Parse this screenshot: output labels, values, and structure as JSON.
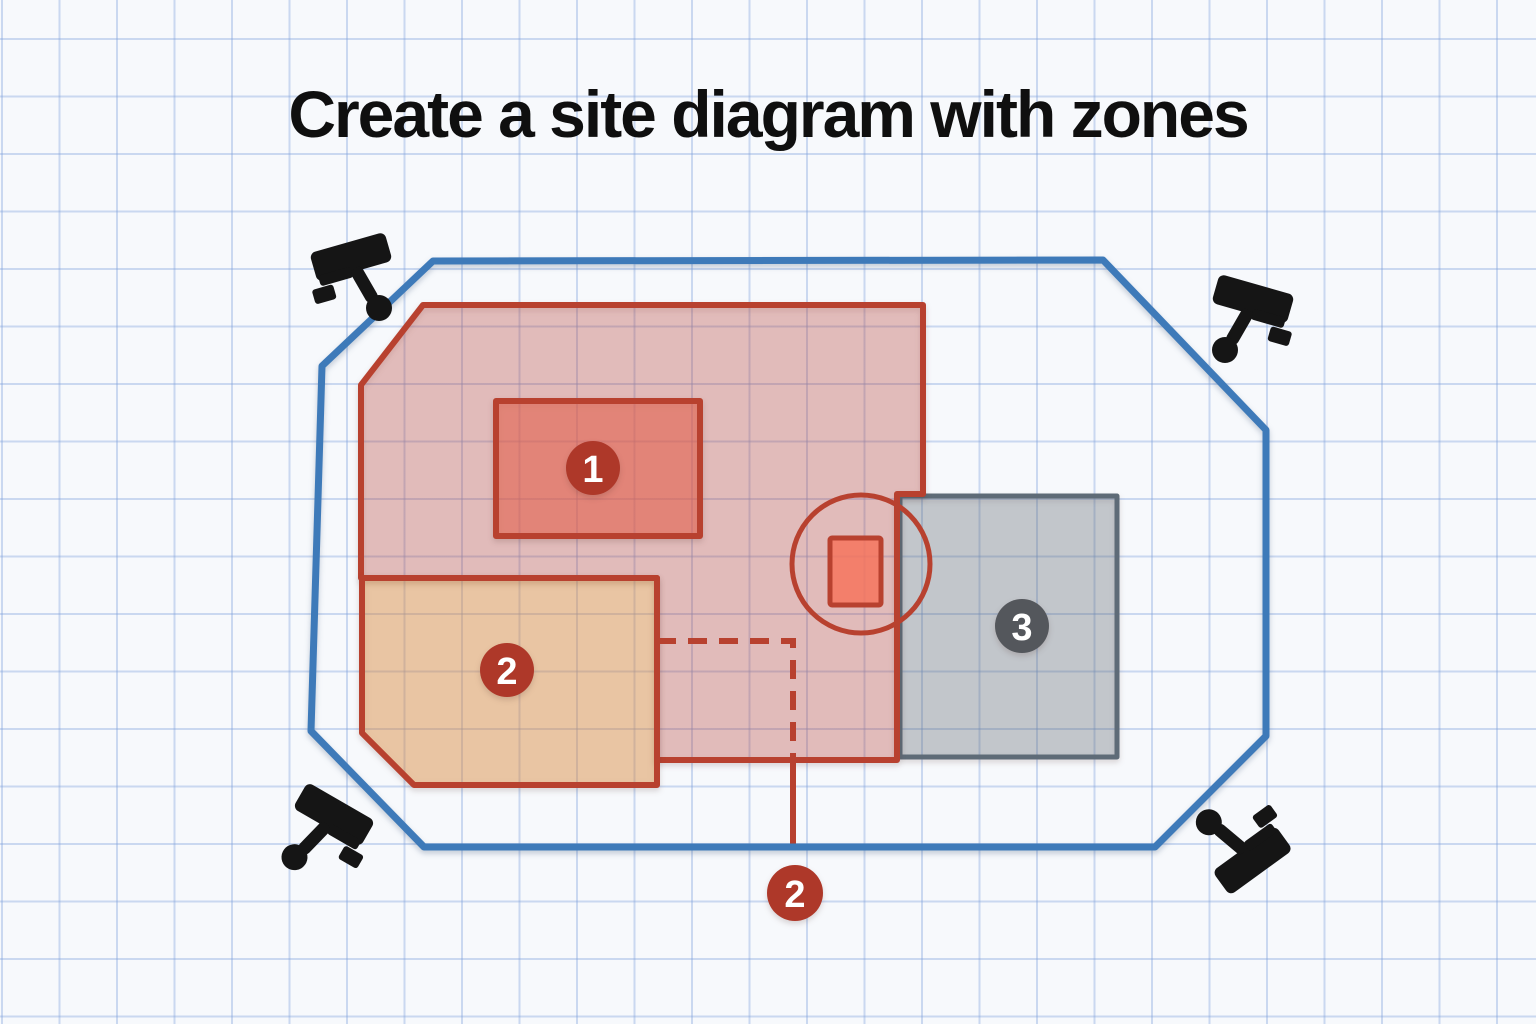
{
  "title": "Create a site diagram with zones",
  "colors": {
    "paper": "#f7f9fc",
    "grid_line": "#cdd9ef",
    "perimeter_blue": "#3e7ab9",
    "zone_red_stroke": "#b8412f",
    "zone_red_fill": "rgba(197,70,58,0.30)",
    "building_fill": "rgba(240,96,72,0.52)",
    "zone_orange_fill": "rgba(231,140,52,0.40)",
    "zone_gray_stroke": "#5e6b77",
    "zone_gray_fill": "rgba(93,105,117,0.30)",
    "equipment_rect_fill": "rgba(247,112,88,0.80)",
    "marker_red": "#ae3829",
    "marker_gray": "#54575c",
    "marker_text": "#ffffff",
    "camera_black": "#151515",
    "title_color": "#0f0f0f"
  },
  "diagram": {
    "perimeter": {
      "name": "site-perimeter-boundary",
      "points": "433,261 1103,260 1266,430 1266,736 1155,847 424,847 311,731 322,366",
      "stroke_key": "perimeter_blue",
      "stroke_width": 7
    },
    "zones": [
      {
        "name": "zone-3-area",
        "shape": "rect",
        "x": 900,
        "y": 496,
        "w": 217,
        "h": 261,
        "fill_key": "zone_gray_fill",
        "stroke_key": "zone_gray_stroke",
        "stroke_width": 5
      },
      {
        "name": "zone-1-area",
        "shape": "polygon",
        "points": "423,305 923,305 923,494 897,494 897,760 657,760 657,578 361,578 361,385",
        "fill_key": "zone_red_fill",
        "stroke_key": "zone_red_stroke",
        "stroke_width": 6
      },
      {
        "name": "zone-2-area",
        "shape": "polygon",
        "points": "362,578 657,578 657,785 414,785 362,733",
        "fill_key": "zone_orange_fill",
        "stroke_key": "zone_red_stroke",
        "stroke_width": 6
      },
      {
        "name": "building-1-rect",
        "shape": "rect",
        "x": 496,
        "y": 401,
        "w": 204,
        "h": 135,
        "fill_key": "building_fill",
        "stroke_key": "zone_red_stroke",
        "stroke_width": 6
      }
    ],
    "dashed_boundary": {
      "name": "zone-2-dashed-boundary",
      "points": "657,641 793,641 793,758",
      "stroke_key": "zone_red_stroke",
      "stroke_width": 6,
      "dash": "19 12"
    },
    "leader_line": {
      "name": "marker-2-leader-line",
      "x1": 793,
      "y1": 758,
      "x2": 793,
      "y2": 844,
      "stroke_key": "zone_red_stroke",
      "stroke_width": 6
    },
    "equipment_circle": {
      "name": "equipment-circle",
      "cx": 861,
      "cy": 564,
      "r": 69,
      "stroke_key": "zone_red_stroke",
      "stroke_width": 5
    },
    "equipment_rect": {
      "name": "equipment-rect",
      "x": 830,
      "y": 538,
      "w": 51,
      "h": 67,
      "fill_key": "equipment_rect_fill",
      "stroke_key": "zone_red_stroke",
      "stroke_width": 5
    },
    "markers": [
      {
        "name": "zone-marker-1",
        "label": "1",
        "x": 593,
        "y": 468,
        "r": 27,
        "fill_key": "marker_red"
      },
      {
        "name": "zone-marker-2",
        "label": "2",
        "x": 507,
        "y": 670,
        "r": 27,
        "fill_key": "marker_red"
      },
      {
        "name": "zone-marker-3",
        "label": "3",
        "x": 1022,
        "y": 626,
        "r": 27,
        "fill_key": "marker_gray"
      },
      {
        "name": "zone-marker-2-callout",
        "label": "2",
        "x": 795,
        "y": 893,
        "r": 28,
        "fill_key": "marker_red"
      }
    ],
    "cameras": [
      {
        "name": "cctv-camera-top-left",
        "x": 300,
        "y": 216,
        "mirror": false,
        "rot": 0
      },
      {
        "name": "cctv-camera-top-right",
        "x": 1194,
        "y": 258,
        "mirror": true,
        "rot": 0
      },
      {
        "name": "cctv-camera-bottom-left",
        "x": 271,
        "y": 772,
        "mirror": true,
        "rot": -14
      },
      {
        "name": "cctv-camera-bottom-right",
        "x": 1188,
        "y": 788,
        "mirror": false,
        "rot": 160
      }
    ]
  }
}
